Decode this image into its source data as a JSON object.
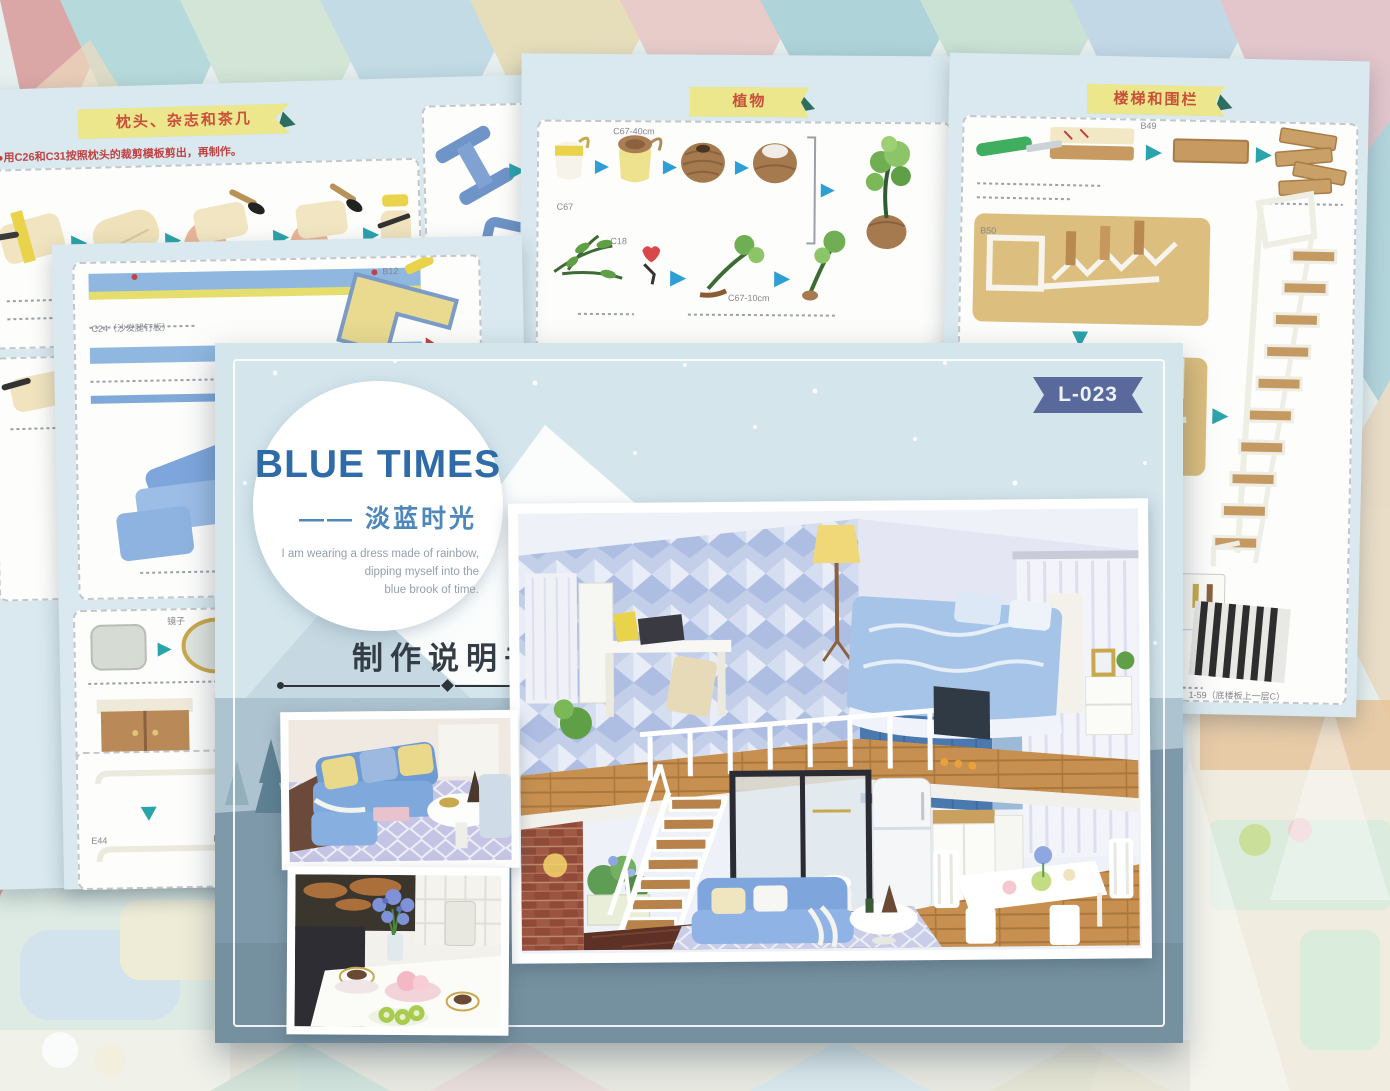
{
  "cover": {
    "badge": "L-023",
    "title": "BLUE TIMES",
    "subtitle_dash": "——",
    "subtitle": "淡蓝时光",
    "tagline_line1": "I am wearing a dress made of rainbow,",
    "tagline_line2": "dipping myself into the",
    "tagline_line3": "blue brook of time.",
    "manual_label": "制作说明书"
  },
  "sheet_pillow": {
    "header": "枕头、杂志和茶几",
    "note": "●用C26和C31按照枕头的裁剪模板剪出，再制作。"
  },
  "sheet_sofa": {
    "label_c24": "C24（沙发腿钉板）",
    "label_b12": "B12",
    "label_mirror": "镜子",
    "label_c44": "C44",
    "label_c49": "C49",
    "label_c13": "C13",
    "label_e44_a": "E44",
    "label_e44_b": "E44"
  },
  "sheet_plants": {
    "header": "植物",
    "label_c67": "C67",
    "label_c67_40": "C67-40cm",
    "label_c18": "C18",
    "label_c67_10": "C67-10cm",
    "label_c16": "C16"
  },
  "sheet_stairs": {
    "header": "楼梯和围栏",
    "label_b49": "B49",
    "label_b50": "B50",
    "label_rug_a": "1-54（底楼板上一层C）",
    "label_rug_b": "1-59（底楼板上一层C）"
  }
}
